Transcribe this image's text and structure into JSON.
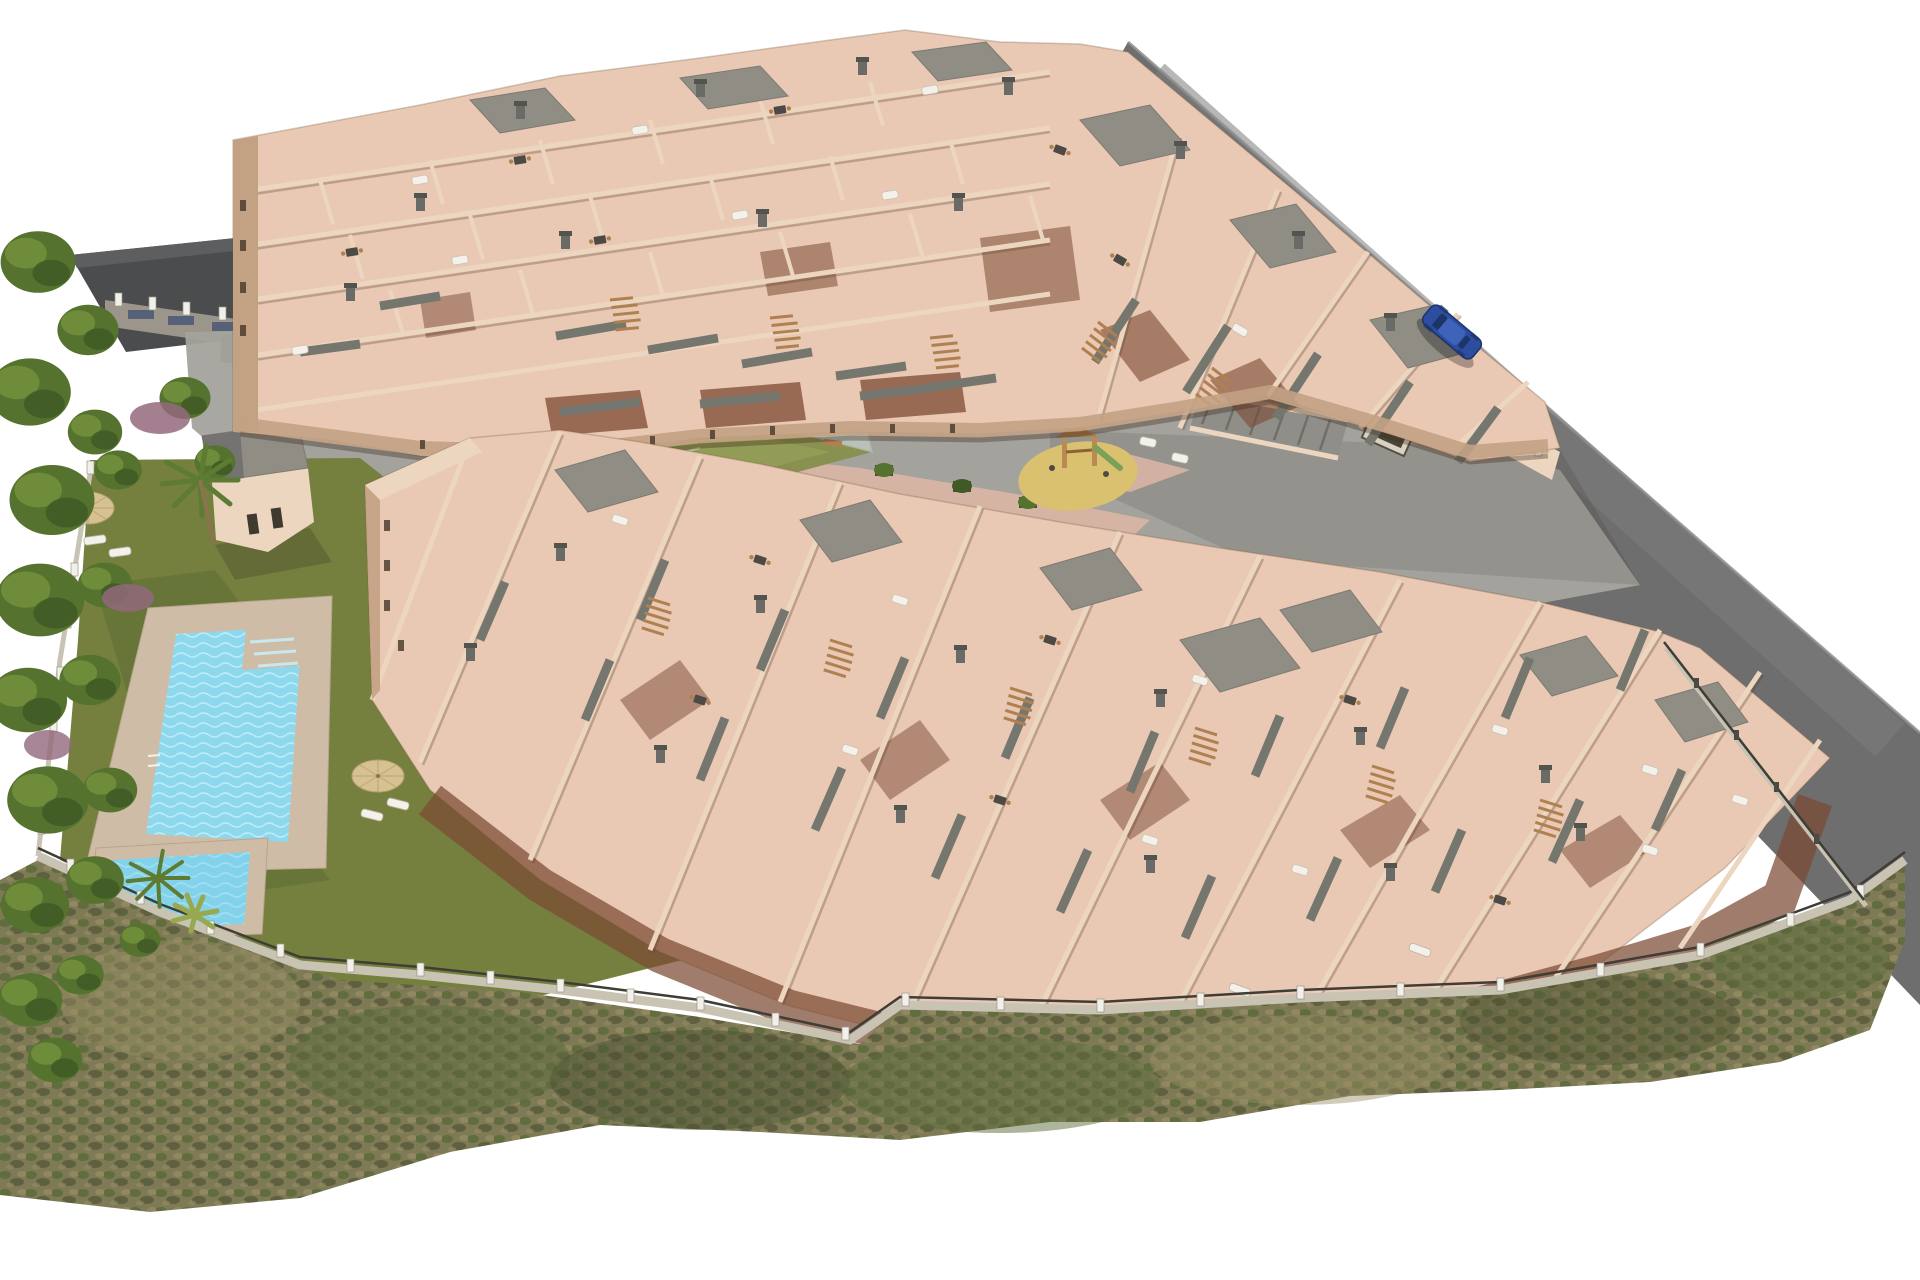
{
  "scene": {
    "type": "aerial-3d-architectural-render",
    "subject": "Bird's-eye 3D visualization of a new-build residential apartment complex",
    "setting": "Two stepped terraced apartment blocks with salmon roof terraces around a paved courtyard, with communal pool, lawn, playground, mini sports pitch, perimeter road, boundary fence, trees and scrubland slope",
    "objects": [
      {
        "name": "upper-apartment-block",
        "label": "Terraced apartment block with roof terraces and balconies"
      },
      {
        "name": "lower-apartment-block",
        "label": "Terraced apartment block with cascading balconies"
      },
      {
        "name": "communal-pool",
        "label": "Communal swimming pool"
      },
      {
        "name": "kids-pool",
        "label": "Children's pool"
      },
      {
        "name": "pool-house",
        "label": "Pool house with flat gray roof"
      },
      {
        "name": "lawn",
        "label": "Communal lawn with sun loungers and straw umbrellas"
      },
      {
        "name": "playground",
        "label": "Children's playground on sand circle"
      },
      {
        "name": "sports-pitch",
        "label": "Mini sports pitch with glass fence"
      },
      {
        "name": "courtyard",
        "label": "Paved communal courtyard with planters and walkways"
      },
      {
        "name": "access-road",
        "label": "Perimeter asphalt access road"
      },
      {
        "name": "parked-car",
        "label": "Blue car parked on the road"
      },
      {
        "name": "perimeter-fence",
        "label": "Boundary wall with white posts and railing"
      },
      {
        "name": "scrubland",
        "label": "Scrubland slope below the plot"
      },
      {
        "name": "trees",
        "label": "Mature pines, palms and purple flowering shrubs"
      },
      {
        "name": "neighbor-building",
        "label": "Neighbouring building with dark roof"
      }
    ]
  },
  "palette": {
    "bg": "#ffffff",
    "road": "#6e6e6e",
    "road_light": "#7d7d7d",
    "neighbor_roof": "#4b4c4e",
    "neighbor_roof_light": "#5d5e60",
    "wall_light": "#ecd6bf",
    "wall_mid": "#dfc3a8",
    "wall_shade": "#c3a183",
    "wall_dark": "#a9886c",
    "terrace": "#e9c9b4",
    "terrace_warm": "#e3b9a2",
    "parapet": "#75776f",
    "roof_gray": "#908d85",
    "roof_gray_dark": "#7d7a72",
    "court_pave": "#a3a29c",
    "court_pave_dark": "#8f8e88",
    "path_pink": "#d8b5a4",
    "field_green": "#8a9150",
    "field_green_light": "#9aa55c",
    "glass": "#cfe0da",
    "sand": "#d9c170",
    "play_wood": "#b98a52",
    "lawn": "#75803f",
    "lawn_shadow": "#5c6a33",
    "tree_dark": "#3f5a24",
    "tree_mid": "#55722e",
    "tree_light": "#6f8c3a",
    "shrub_purple": "#93687b",
    "palm_green": "#5e7b33",
    "scrub_base": "#7d7a55",
    "scrub_green": "#5d6b3b",
    "scrub_dry": "#9a8e66",
    "scrub_dark": "#4a4f30",
    "fence_wall": "#c9c3b4",
    "fence_post": "#f2f0ea",
    "fence_rail": "#3e3e36",
    "pool_deck": "#cfbca6",
    "pool_water": "#8ed8ee",
    "pool_water_light": "#c5eef8",
    "pool_water_deep": "#6fc8e4",
    "car_blue": "#2c4da0",
    "car_dark": "#1d3468",
    "white_furn": "#f4f1ea",
    "dark_furn": "#4d4a45",
    "wood_furn": "#b08050",
    "umbrella_straw": "#d6c193",
    "under_balcony": "#7c4a33"
  }
}
